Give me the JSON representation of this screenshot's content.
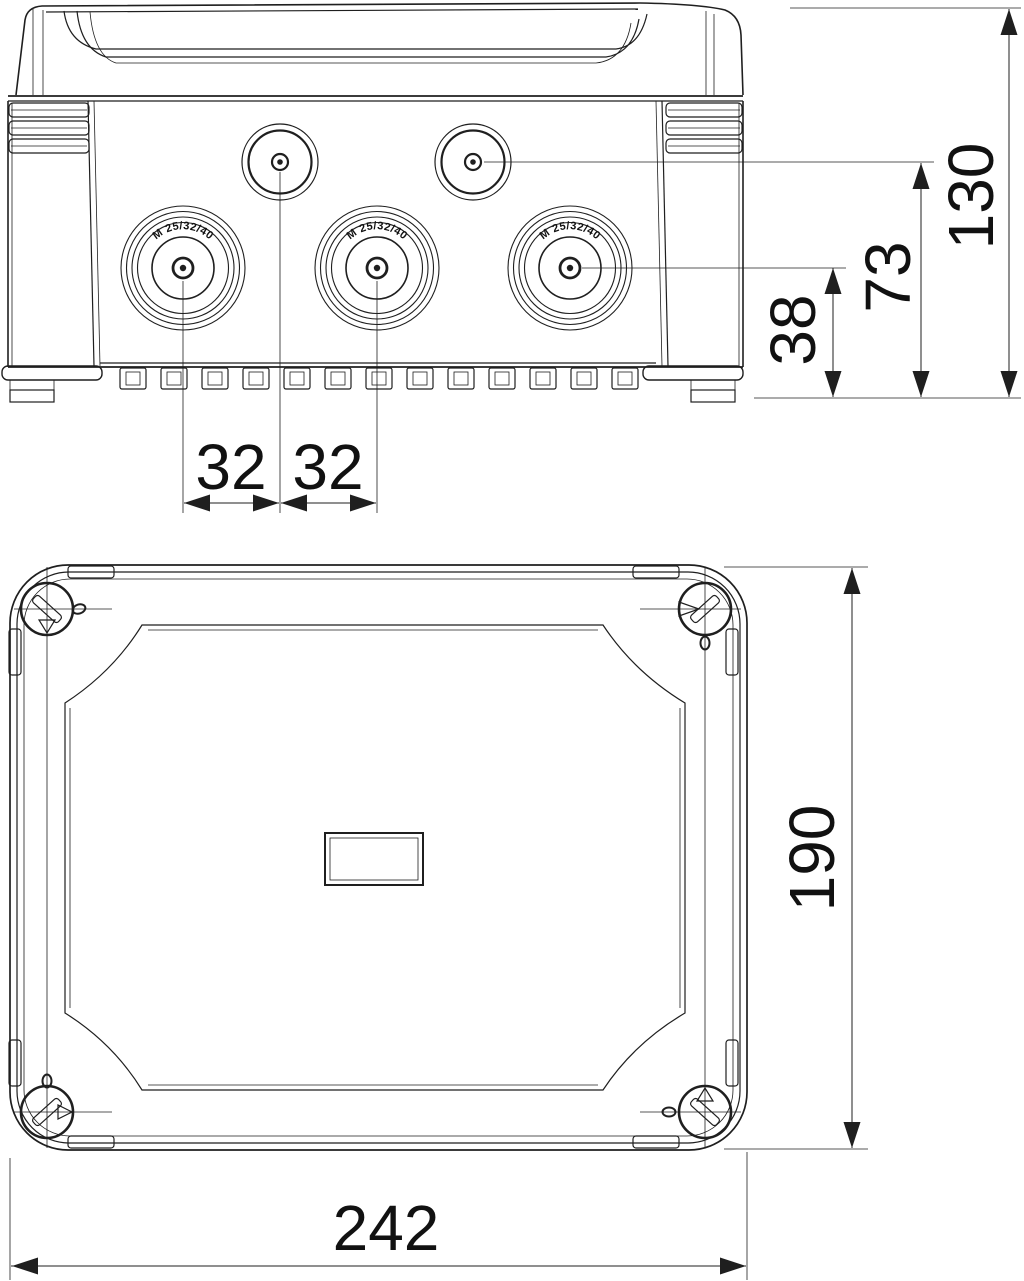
{
  "drawing": {
    "title": "junction-box-dimensional-drawing",
    "line_color": "#1f1f1f",
    "text_color": "#111111",
    "entry_label": "M 25/32/40",
    "dims": {
      "overall_height": "130",
      "small_entry_center_height": "73",
      "large_entry_center_height": "38",
      "entry_spacing_left": "32",
      "entry_spacing_right": "32",
      "plan_depth": "190",
      "plan_width": "242"
    }
  }
}
